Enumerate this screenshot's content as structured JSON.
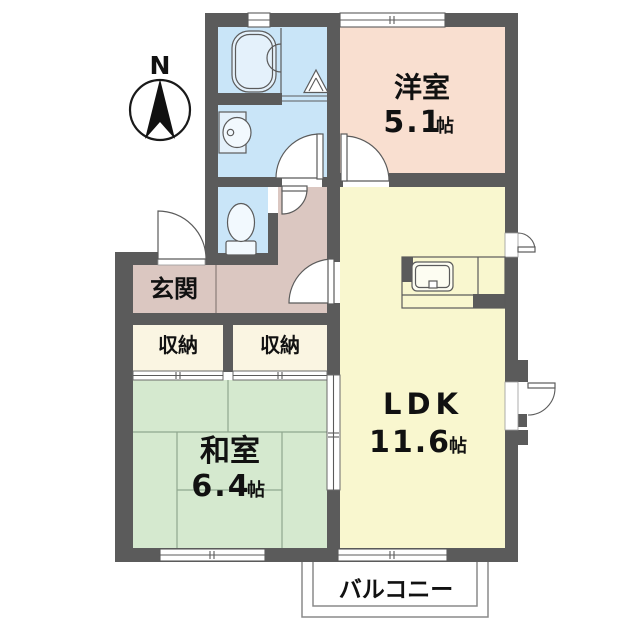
{
  "compass": {
    "label": "N"
  },
  "rooms": {
    "western": {
      "name": "洋室",
      "size_value": "5.1",
      "size_unit": "帖"
    },
    "ldk": {
      "name": "LDK",
      "size_value": "11.6",
      "size_unit": "帖"
    },
    "japanese": {
      "name": "和室",
      "size_value": "6.4",
      "size_unit": "帖"
    },
    "entrance": {
      "name": "玄関"
    },
    "storage_left": {
      "name": "収納"
    },
    "storage_right": {
      "name": "収納"
    },
    "balcony": {
      "name": "バルコニー"
    }
  },
  "colors": {
    "wall": "#5b5b5b",
    "western_room": "#f9dfd0",
    "ldk": "#f9f7cf",
    "japanese_room": "#d5e9cf",
    "wet_area": "#c9e5f8",
    "fixture": "#e4f1fb",
    "hall": "#dbc7c1",
    "storage": "#faf5e2"
  }
}
